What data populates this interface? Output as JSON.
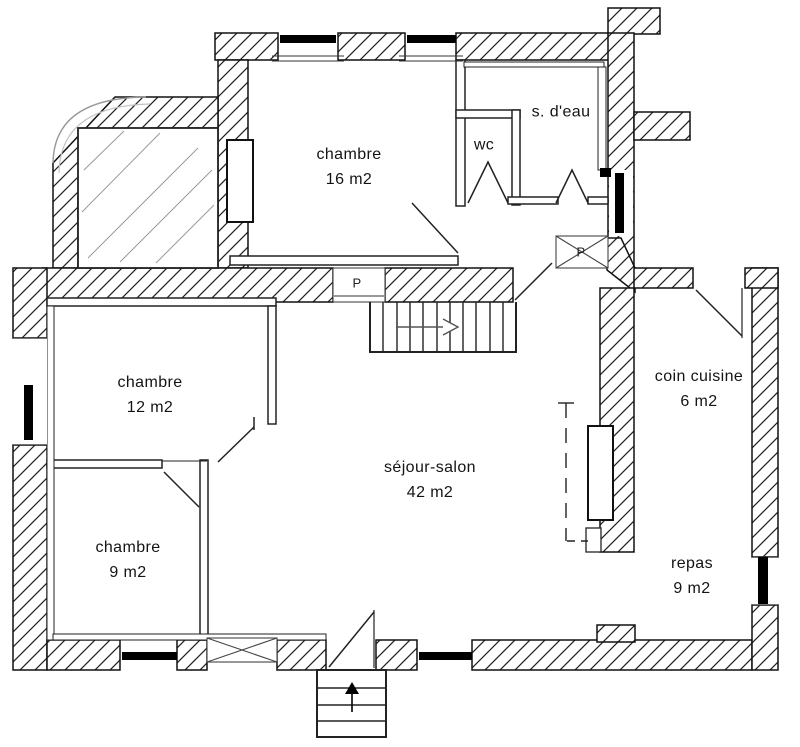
{
  "plan": {
    "title": "floor-plan",
    "rooms": [
      {
        "id": "chambre-16",
        "name": "chambre",
        "area": "16 m2"
      },
      {
        "id": "salle-deau",
        "name": "s. d'eau",
        "area": ""
      },
      {
        "id": "wc",
        "name": "wc",
        "area": ""
      },
      {
        "id": "chambre-12",
        "name": "chambre",
        "area": "12 m2"
      },
      {
        "id": "chambre-9",
        "name": "chambre",
        "area": "9 m2"
      },
      {
        "id": "sejour",
        "name": "séjour-salon",
        "area": "42 m2"
      },
      {
        "id": "cuisine",
        "name": "coin cuisine",
        "area": "6 m2"
      },
      {
        "id": "repas",
        "name": "repas",
        "area": "9 m2"
      }
    ],
    "closet_label": "P",
    "colors": {
      "line": "#1a1a1a",
      "hatch": "#222222",
      "glass": "#9a9a9a",
      "background": "#ffffff"
    }
  }
}
